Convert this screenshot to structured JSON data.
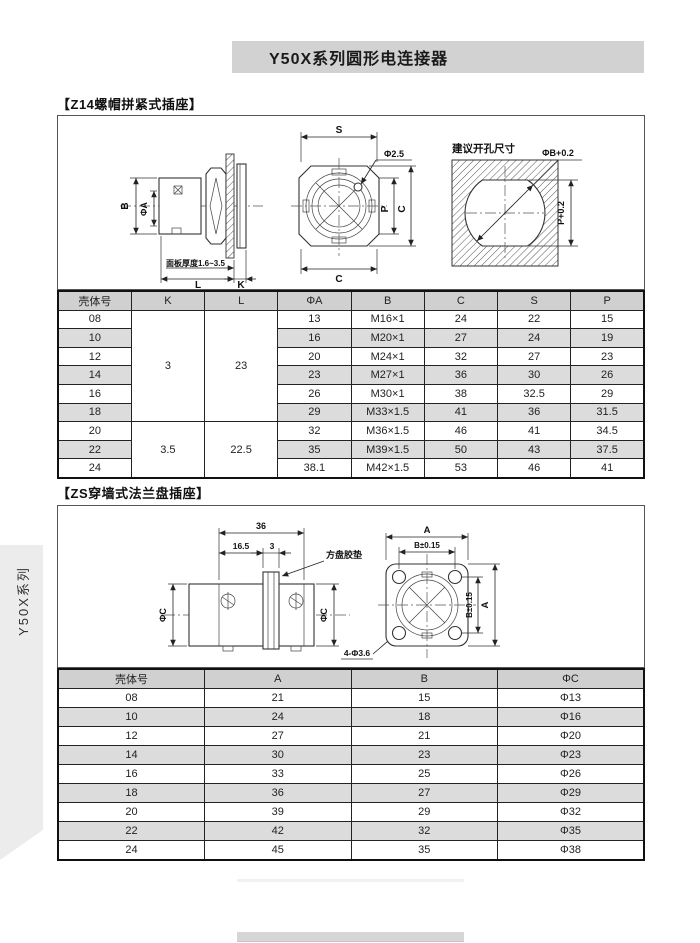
{
  "page": {
    "title": "Y50X系列圆形电连接器",
    "sidebar_label": "Y50X系列"
  },
  "colors": {
    "title_bar_bg": "#d2d2d2",
    "table_header_bg": "#d0d0d0",
    "row_stripe_bg": "#dcdcdc",
    "sidebar_tab_bg": "#ececec",
    "footer_bar_bg": "#d6d6d6",
    "line_color": "#222222"
  },
  "section1": {
    "heading": "【Z14螺帽拼紧式插座】",
    "drawing": {
      "b": "B",
      "phiA": "ΦA",
      "panel_note": "面板厚度1.6~3.5",
      "l": "L",
      "k": "K",
      "s": "S",
      "phi25": "Φ2.5",
      "p": "P",
      "c": "C",
      "hole_title": "建议开孔尺寸",
      "phiB": "ΦB+0.2",
      "p02": "P+0.2"
    },
    "table": {
      "headers": [
        "壳体号",
        "K",
        "L",
        "ΦA",
        "B",
        "C",
        "S",
        "P"
      ],
      "k_groups": [
        {
          "start": 0,
          "span": 6,
          "k": "3",
          "l": "23"
        },
        {
          "start": 6,
          "span": 3,
          "k": "3.5",
          "l": "22.5"
        }
      ],
      "rows": [
        [
          "08",
          "13",
          "M16×1",
          "24",
          "22",
          "15"
        ],
        [
          "10",
          "16",
          "M20×1",
          "27",
          "24",
          "19"
        ],
        [
          "12",
          "20",
          "M24×1",
          "32",
          "27",
          "23"
        ],
        [
          "14",
          "23",
          "M27×1",
          "36",
          "30",
          "26"
        ],
        [
          "16",
          "26",
          "M30×1",
          "38",
          "32.5",
          "29"
        ],
        [
          "18",
          "29",
          "M33×1.5",
          "41",
          "36",
          "31.5"
        ],
        [
          "20",
          "32",
          "M36×1.5",
          "46",
          "41",
          "34.5"
        ],
        [
          "22",
          "35",
          "M39×1.5",
          "50",
          "43",
          "37.5"
        ],
        [
          "24",
          "38.1",
          "M42×1.5",
          "53",
          "46",
          "41"
        ]
      ]
    }
  },
  "section2": {
    "heading": "【ZS穿墙式法兰盘插座】",
    "drawing": {
      "d36": "36",
      "d165": "16.5",
      "d3": "3",
      "gasket": "方盘胶垫",
      "phiC": "ΦC",
      "holes": "4-Φ3.6",
      "a": "A",
      "b015": "B±0.15"
    },
    "table": {
      "headers": [
        "壳体号",
        "A",
        "B",
        "ΦC"
      ],
      "rows": [
        [
          "08",
          "21",
          "15",
          "Φ13"
        ],
        [
          "10",
          "24",
          "18",
          "Φ16"
        ],
        [
          "12",
          "27",
          "21",
          "Φ20"
        ],
        [
          "14",
          "30",
          "23",
          "Φ23"
        ],
        [
          "16",
          "33",
          "25",
          "Φ26"
        ],
        [
          "18",
          "36",
          "27",
          "Φ29"
        ],
        [
          "20",
          "39",
          "29",
          "Φ32"
        ],
        [
          "22",
          "42",
          "32",
          "Φ35"
        ],
        [
          "24",
          "45",
          "35",
          "Φ38"
        ]
      ]
    }
  }
}
